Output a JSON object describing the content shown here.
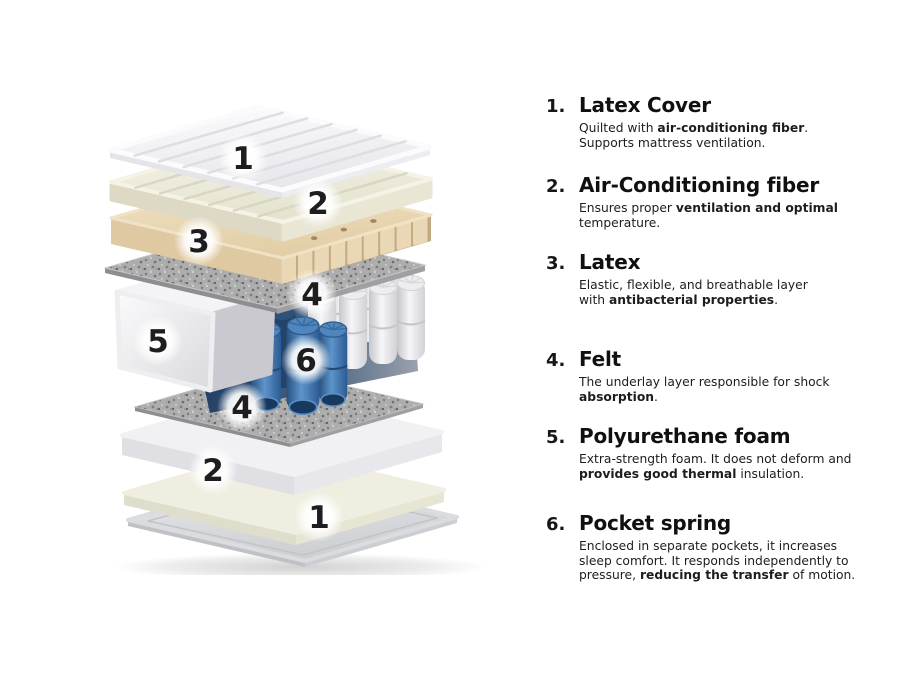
{
  "diagram": {
    "callouts": {
      "c1": "1",
      "c2": "2",
      "c3": "3",
      "c4": "4",
      "c5": "5",
      "c6": "6",
      "c4b": "4",
      "c2b": "2",
      "c1b": "1"
    },
    "colors": {
      "cover_white": "#f2f2f5",
      "fiber_cream": "#f1f0e2",
      "latex_beige": "#ecdbbb",
      "felt_gray": "#a9a9a9",
      "foam_white": "#f3f3f5",
      "spring_blue": "#3a6ca8",
      "spring_white": "#ededf0",
      "number_ink": "#1e1e20"
    }
  },
  "items": [
    {
      "num": "1.",
      "title": "Latex Cover",
      "body": [
        {
          "t": "Quilted with "
        },
        {
          "t": "air-conditioning fiber",
          "b": 1
        },
        {
          "t": "."
        },
        {
          "br": 1
        },
        {
          "t": "Supports mattress ventilation."
        }
      ]
    },
    {
      "num": "2.",
      "title": "Air-Conditioning fiber",
      "body": [
        {
          "t": "Ensures proper "
        },
        {
          "t": "ventilation and optimal",
          "b": 1
        },
        {
          "t": " temperature."
        }
      ]
    },
    {
      "num": "3.",
      "title": "Latex",
      "body": [
        {
          "t": "Elastic, flexible, and breathable layer"
        },
        {
          "br": 1
        },
        {
          "t": "with "
        },
        {
          "t": "antibacterial properties",
          "b": 1
        },
        {
          "t": "."
        }
      ]
    },
    {
      "num": "4.",
      "title": "Felt",
      "body": [
        {
          "t": "The underlay layer responsible for shock "
        },
        {
          "t": "absorption",
          "b": 1
        },
        {
          "t": "."
        }
      ]
    },
    {
      "num": "5.",
      "title": "Polyurethane foam",
      "body": [
        {
          "t": "Extra-strength foam. It does not deform and"
        },
        {
          "br": 1
        },
        {
          "t": "provides good thermal",
          "b": 1
        },
        {
          "t": " insulation."
        }
      ]
    },
    {
      "num": "6.",
      "title": "Pocket spring",
      "body": [
        {
          "t": "Enclosed in separate pockets, it increases"
        },
        {
          "br": 1
        },
        {
          "t": "sleep comfort. It responds independently to"
        },
        {
          "br": 1
        },
        {
          "t": "pressure, "
        },
        {
          "t": "reducing the transfer",
          "b": 1
        },
        {
          "t": " of motion."
        }
      ]
    }
  ]
}
